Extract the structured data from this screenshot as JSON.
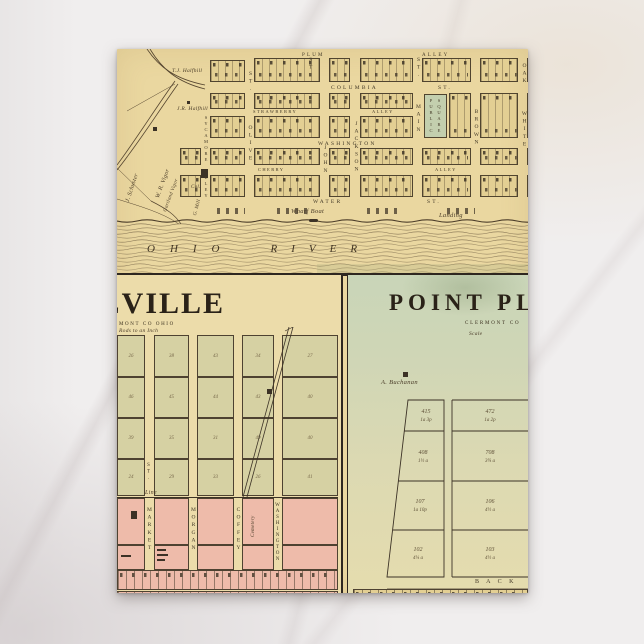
{
  "postcard": {
    "top_map": {
      "streets": {
        "plum": "PLUM",
        "alley_top": "ALLEY",
        "columbia": "COLUMBIA",
        "columbia_st": "ST.",
        "strawberry": "STRAWBERRY",
        "strawberry_alley": "ALLEY",
        "washington": "WASHINGTON",
        "cherry": "CHERRY",
        "mid_alley": "ALLEY",
        "water": "WATER",
        "water_st": "ST.",
        "sycamore_alley": "SYCAMORE ALLEY",
        "olive": "OLIVE",
        "olive_st": "ST.",
        "st_v1": "ST.",
        "john": "JOHN",
        "jackson": "JACKSON",
        "main": "MAIN",
        "main_st": "ST.",
        "brown": "BROWN",
        "white": "WHITE",
        "oak": "OAK"
      },
      "public_square_1": "PUBLIC",
      "public_square_2": "SQUARE",
      "labels": {
        "wharf_boat": "Wharf Boat",
        "landing": "Landing",
        "ohio": "OHIO",
        "river": "RIVER",
        "owner_1": "J. Schuster",
        "owner_2": "W. R. Vigor",
        "owner_3": "T.J. Halfhill",
        "owner_4": "J.R. Halfhill",
        "owner_5": "Gartland Vigor",
        "owner_6": "Cal.",
        "owner_7": "G. Mill"
      }
    },
    "panel_left": {
      "title": "NEVILLE",
      "subtitle": "MONT CO OHIO",
      "scale_note": "Rods to an Inch",
      "streets": [
        "MARKET",
        "MORGAN",
        "COFFEY",
        "WASHINGTON"
      ],
      "street_st": "ST.",
      "line_label": "Line",
      "cemetery": "Cemetery",
      "lot_numbers": [
        "26",
        "38",
        "43",
        "34",
        "27",
        "46",
        "45",
        "44",
        "43",
        "40",
        "39",
        "35",
        "31",
        "49",
        "40",
        "24",
        "29",
        "33",
        "26",
        "41"
      ]
    },
    "panel_right": {
      "title": "POINT PLEASANT",
      "subtitle": "CLERMONT CO",
      "scale_label": "Scale",
      "owner": "A. Buchanan",
      "back_street": "B A C K",
      "lots_left": [
        {
          "num": "415",
          "area": "1a 3p"
        },
        {
          "num": "408",
          "area": "1½ a"
        },
        {
          "num": "107",
          "area": "1a 10p"
        },
        {
          "num": "102",
          "area": "4¼ a"
        }
      ],
      "lots_right": [
        {
          "num": "472",
          "area": "1a 2p"
        },
        {
          "num": "708",
          "area": "3¾ a"
        },
        {
          "num": "106",
          "area": "4½ a"
        },
        {
          "num": "103",
          "area": "4½ a"
        }
      ]
    },
    "colors": {
      "cream": "#ead7a0",
      "olive_lot": "#d6d1a3",
      "pink": "#eebbaa",
      "green_panel": "#ccd6b8",
      "square_green": "#c3cfae",
      "ink": "#352c22"
    }
  }
}
